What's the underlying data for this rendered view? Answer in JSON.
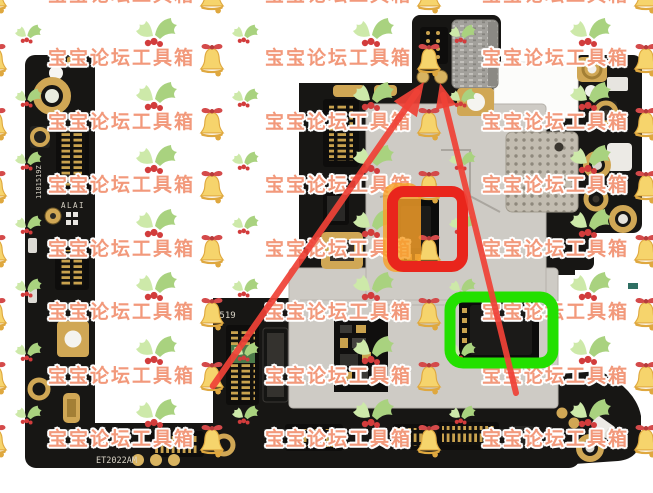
{
  "meta": {
    "description": "Photo of a smartphone motherboard on a white background, covered by a repeating forum watermark, with repair annotations: an orange highlight, a red box and a green box around two shield-cutout chips, and two red arrows pointing to two gold test points at the top edge of the board."
  },
  "watermark": {
    "text": "宝宝论坛工具箱",
    "text_color": "#f2997b",
    "outline_color": "#ffffff",
    "bell_color": "#f6d46c",
    "bell_shade": "#dfa83f",
    "bow_color": "#d44a4a",
    "holly_leaf_color": "#a9d27f",
    "holly_leaf_light": "#cde9a9",
    "berry_color": "#d23c3c"
  },
  "board": {
    "silkscreen_labels": [
      {
        "id": "bottom-model-code",
        "text": "ET2022AM"
      },
      {
        "id": "mid-left-code",
        "text": "9519"
      },
      {
        "id": "left-strip-code",
        "text": "ALAI"
      },
      {
        "id": "left-strip-vertical-code",
        "text": "1181519Z"
      }
    ],
    "colors": {
      "pcb": "#171614",
      "pcb_light": "#24221f",
      "gold": "#d0a755",
      "gold_dark": "#8a6d33",
      "shield": "#cecbc5",
      "shield_dark": "#b5b1aa",
      "perforated": "#c2bcb0",
      "perforated_dot": "#8e887c",
      "sticker": "#fcfcfa",
      "silkscreen": "#d8d3c6",
      "camera_body": "#a3a19c"
    }
  },
  "annotations": {
    "orange_highlight": {
      "color": "#f6a028"
    },
    "red_box": {
      "color": "#e9251c"
    },
    "green_box": {
      "color": "#23e000"
    },
    "arrow_color": "#ef4237",
    "arrows": [
      {
        "from": "lower-left shield area",
        "to": "left gold test point"
      },
      {
        "from": "below green box",
        "to": "right gold test point"
      }
    ],
    "test_points": {
      "count": 2,
      "color": "#d8b360"
    }
  }
}
